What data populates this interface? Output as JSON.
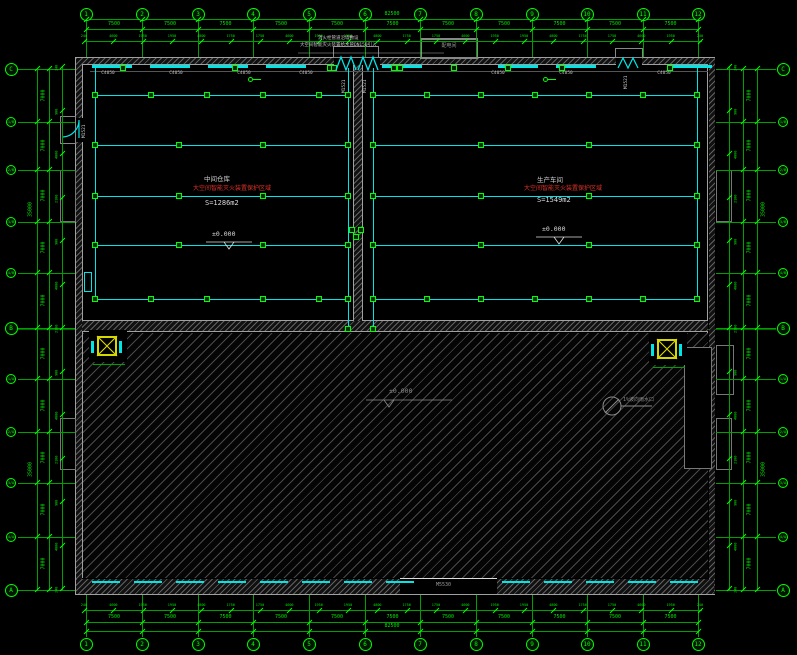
{
  "grid": {
    "top": {
      "labels": [
        "1",
        "2",
        "3",
        "4",
        "5",
        "6",
        "7",
        "8",
        "9",
        "10",
        "11",
        "12"
      ],
      "bays": [
        "7500",
        "7500",
        "7500",
        "7500",
        "7500",
        "7500",
        "7500",
        "7500",
        "7500",
        "7500",
        "7500"
      ],
      "overall": "82500",
      "detail": [
        "240",
        "4600",
        "1950",
        "1950",
        "4800",
        "1750",
        "1750",
        "4600",
        "1950",
        "1950",
        "4800",
        "1750",
        "1750",
        "4600",
        "1950",
        "1950",
        "4800",
        "1750",
        "1750",
        "4600",
        "1950",
        "240"
      ]
    },
    "bottom": {
      "labels": [
        "1",
        "2",
        "3",
        "4",
        "5",
        "6",
        "7",
        "8",
        "9",
        "10",
        "11",
        "12"
      ],
      "bays": [
        "7500",
        "7500",
        "7500",
        "7500",
        "7500",
        "7500",
        "7500",
        "7500",
        "7500",
        "7500",
        "7500"
      ],
      "overall": "82500",
      "detail": [
        "240",
        "4600",
        "1950",
        "1950",
        "4800",
        "1750",
        "1750",
        "4600",
        "1950",
        "1950",
        "4800",
        "1750",
        "1750",
        "4600",
        "1950",
        "1950",
        "4800",
        "1750",
        "1750",
        "4600",
        "1950",
        "240"
      ]
    },
    "left": {
      "labels": [
        "C",
        "1/B",
        "2/B",
        "3/B",
        "4/B",
        "B",
        "1/A",
        "2/A",
        "3/A",
        "4/A",
        "A"
      ],
      "bays": [
        "7000",
        "7000",
        "7000",
        "7000",
        "7000",
        "7000",
        "7000",
        "7000",
        "7000",
        "7000"
      ],
      "overall_upper": "35000",
      "overall_lower": "35000",
      "detail": [
        "240",
        "900",
        "4000",
        "2100",
        "900",
        "4000",
        "2100",
        "900",
        "4000",
        "2100",
        "900",
        "4000",
        "240"
      ]
    },
    "right": {
      "labels": [
        "C",
        "1/B",
        "2/B",
        "3/B",
        "4/B",
        "B",
        "1/A",
        "2/A",
        "3/A",
        "4/A",
        "A"
      ],
      "bays": [
        "7000",
        "7000",
        "7000",
        "7000",
        "7000",
        "7000",
        "7000",
        "7000",
        "7000",
        "7000"
      ],
      "overall_upper": "35000",
      "overall_lower": "35000",
      "detail": [
        "240",
        "900",
        "4000",
        "2100",
        "900",
        "4000",
        "2100",
        "900",
        "4000",
        "2100",
        "900",
        "4000",
        "240"
      ]
    }
  },
  "rooms": {
    "left": {
      "name": "中间仓库",
      "note": "大空间智能灭火装置保护区域",
      "area": "S=1286m2",
      "elevation": "±0.000"
    },
    "right": {
      "name": "生产车间",
      "note": "大空间智能灭火装置保护区域",
      "area": "S=1549m2",
      "elevation": "±0.000"
    },
    "yard": {
      "elevation": "±0.000",
      "slope_note": "1%坡向雨水口"
    }
  },
  "annex": {
    "label": "配电间"
  },
  "notes": {
    "line1": "消火栓管道沿墙敷设",
    "line2": "大空间智能灭火装置给水管DN150引入"
  },
  "doors": {
    "main": "M1521",
    "bottom": "M5530"
  },
  "windows": {
    "label": "C4050"
  },
  "colors": {
    "axis_line": "#00a000",
    "axis_text": "#00e800",
    "tick": "#00ff00",
    "pipe": "#00e5e5",
    "wall": "#a0a0a0",
    "hatch": "#6e6e6e",
    "room_text": "#d8d8d8",
    "note_red": "#e03328",
    "gray_anno": "#8c8c8c",
    "equipment_yellow": "#d6d600"
  }
}
